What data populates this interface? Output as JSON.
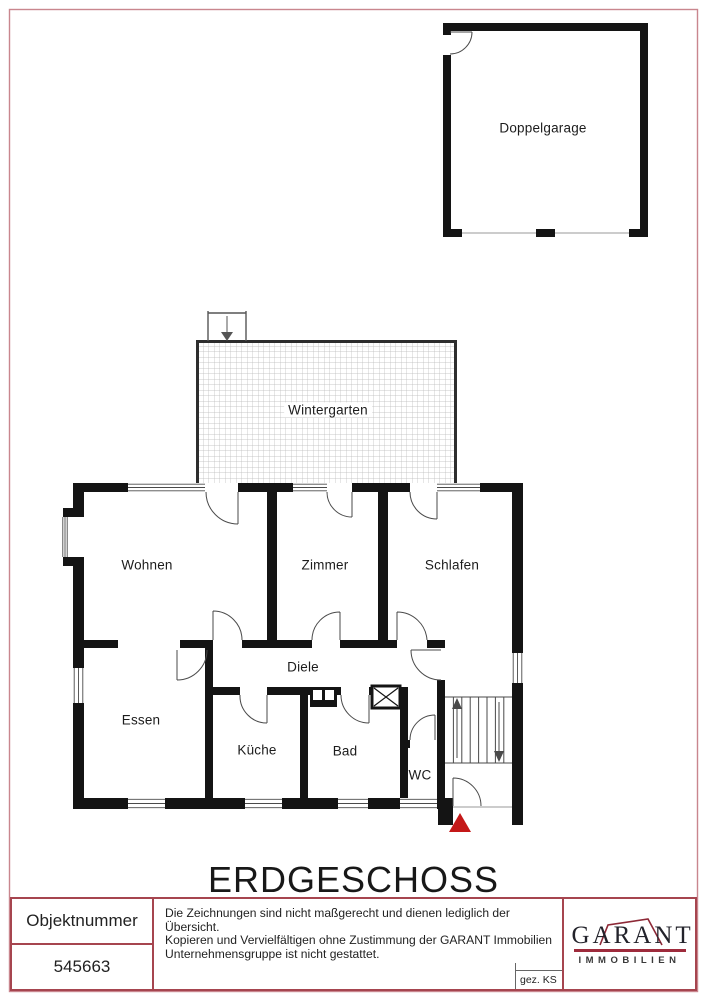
{
  "title": "ERDGESCHOSS",
  "rooms": {
    "doppelgarage": "Doppelgarage",
    "wintergarten": "Wintergarten",
    "wohnen": "Wohnen",
    "zimmer": "Zimmer",
    "schlafen": "Schlafen",
    "diele": "Diele",
    "essen": "Essen",
    "kueche": "Küche",
    "bad": "Bad",
    "wc": "WC"
  },
  "footer": {
    "object_number_label": "Objektnummer",
    "object_number": "545663",
    "disclaimer": {
      "line1": "Die Zeichnungen sind nicht maßgerecht und dienen lediglich der Übersicht.",
      "line2": "Kopieren und Vervielfältigen ohne Zustimmung der GARANT Immobilien",
      "line3": "Unternehmensgruppe ist nicht gestattet."
    },
    "drawn_by": "gez. KS",
    "logo": {
      "name": "GARANT",
      "subtitle": "IMMOBILIEN"
    }
  },
  "colors": {
    "wall": "#141414",
    "page_border": "#c9868e",
    "footer_border": "#a6454f",
    "logo_accent": "#9e2b3c",
    "entrance_marker": "#c41818"
  }
}
